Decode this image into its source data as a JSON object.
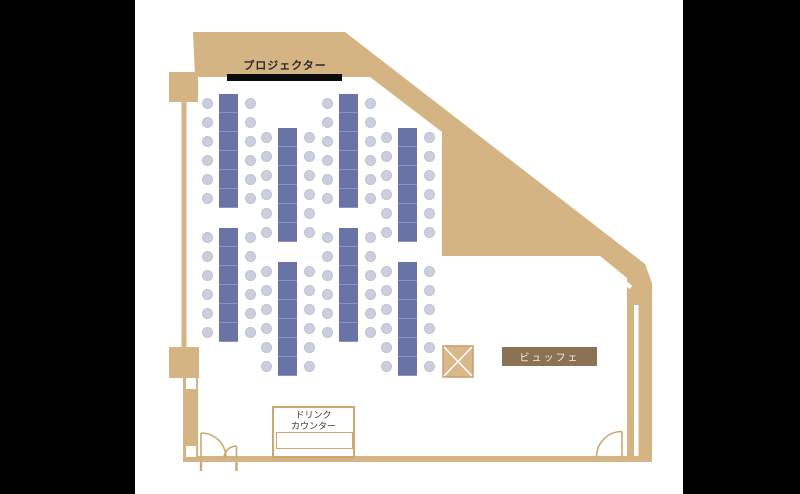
{
  "labels": {
    "projector": "プロジェクター",
    "buffet": "ビュッフェ",
    "drink_counter_line1": "ドリンク",
    "drink_counter_line2": "カウンター"
  },
  "colors": {
    "letterbox": "#000000",
    "wall": "#D5B484",
    "wall_border": "#C9A871",
    "door_stroke": "#CBA873",
    "screen": "#0a0a0a",
    "table": "#6973A6",
    "table_divider": "#8C94C0",
    "chair": "#CBCFDD",
    "chair_border": "#BDC2D4",
    "buffet_bg": "#8B7254",
    "buffet_text": "#F6EFE3",
    "crosshatch_fill": "#D9B88A",
    "crosshatch_border": "#C4A06A",
    "crosshatch_lines": "#FFFFFF"
  },
  "floorplan": {
    "room_type": "banquet-seminar room",
    "tables": {
      "count": 8,
      "width": 19,
      "height": 114,
      "segments": 6,
      "chairs_per_side": 6,
      "positions": [
        {
          "x": 219,
          "y": 94
        },
        {
          "x": 278,
          "y": 128
        },
        {
          "x": 339,
          "y": 94
        },
        {
          "x": 398,
          "y": 128
        },
        {
          "x": 219,
          "y": 228
        },
        {
          "x": 278,
          "y": 262
        },
        {
          "x": 339,
          "y": 228
        },
        {
          "x": 398,
          "y": 262
        }
      ]
    },
    "chairs_total": 96
  }
}
